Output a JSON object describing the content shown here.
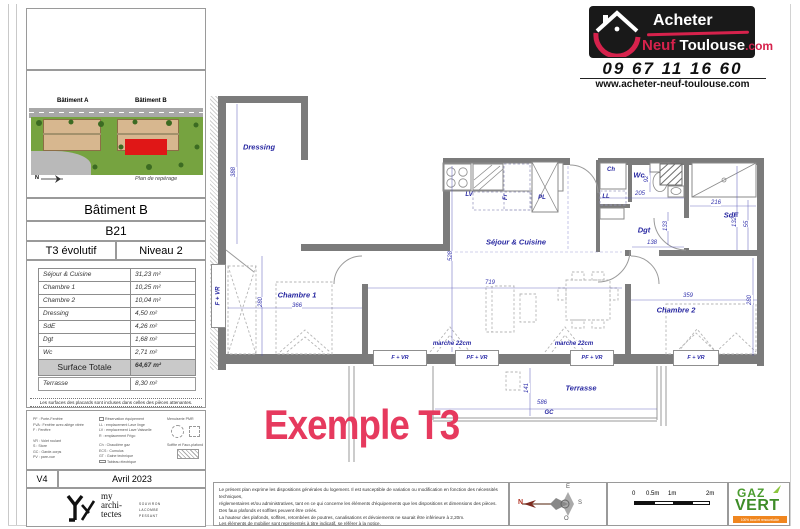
{
  "header": {
    "logo": {
      "acheter": "Acheter",
      "neuf": "Neuf",
      "toulouse": "Toulouse",
      "com": ".com"
    },
    "phone": "09 67 11 16 60",
    "website": "www.acheter-neuf-toulouse.com"
  },
  "sidebar": {
    "siteplan": {
      "building_a": "Bâtiment A",
      "building_b": "Bâtiment B",
      "caption": "Plan de repérage",
      "north": "N"
    },
    "unit": {
      "building": "Bâtiment B",
      "code": "B21",
      "type": "T3 évolutif",
      "level": "Niveau 2"
    },
    "areas": {
      "rows": [
        {
          "label": "Séjour & Cuisine",
          "value": "31,23 m²"
        },
        {
          "label": "Chambre 1",
          "value": "10,25 m²"
        },
        {
          "label": "Chambre 2",
          "value": "10,04 m²"
        },
        {
          "label": "Dressing",
          "value": "4,50 m²"
        },
        {
          "label": "SdE",
          "value": "4,26 m²"
        },
        {
          "label": "Dgt",
          "value": "1,68 m²"
        },
        {
          "label": "Wc",
          "value": "2,71 m²"
        }
      ],
      "total": {
        "label": "Surface Totale",
        "value": "64,67 m²"
      },
      "terrace": {
        "label": "Terrasse",
        "value": "8,30 m²"
      },
      "note": "Les surfaces des placards sont incluses dans celles des pièces attenantes."
    },
    "legend": {
      "col1": [
        "PF : Porte-Fenêtre",
        "FVA : Fenêtre avec allège vitrée",
        "F : Fenêtre",
        "VR : Volet roulant",
        "S : Store",
        "GC : Garde-corps",
        "PV : pare-vue"
      ],
      "col2": [
        "Réservation équipement",
        "LL : emplacement Lave linge",
        "LV : emplacement Lave Vaisselle",
        "R : emplacement Frigo",
        "Ch : Chaudière gaz",
        "ECS : Cumulus",
        "GT : Gaine technique",
        "Tableau électrique"
      ],
      "pmr": "Menuiserie PMR",
      "soffite": "Soffite et Faux-plafond"
    },
    "version": "V4",
    "date": "Avril 2023",
    "architect": {
      "l1": "my",
      "l2": "archi-",
      "l3": "tectes",
      "p1": "SOUVIRON",
      "p2": "LACOMBE",
      "p3": "PESSANT"
    }
  },
  "plan": {
    "rooms": {
      "dressing": "Dressing",
      "sejour": "Séjour & Cuisine",
      "chambre1": "Chambre 1",
      "chambre2": "Chambre 2",
      "sde": "SdE",
      "dgt": "Dgt",
      "wc": "Wc",
      "terrasse": "Terrasse"
    },
    "labels": {
      "lv": "LV",
      "fr": "Fr",
      "pl": "PL",
      "ch": "Ch",
      "ll": "LL",
      "gc": "GC",
      "marche": "marche 22cm"
    },
    "windows": {
      "f_vr": "F + VR",
      "pf_vr": "PF + VR"
    },
    "dims": {
      "d388": "388",
      "d280a": "280",
      "d366": "366",
      "d719": "719",
      "d528": "528",
      "d359": "359",
      "d280b": "280",
      "d205": "205",
      "d92": "92",
      "d216": "216",
      "d132": "132",
      "d55": "55",
      "d138": "138",
      "d133": "133",
      "d141": "141",
      "d586": "586"
    },
    "example": "Exemple T3"
  },
  "footer": {
    "disclaimer": [
      "Le présent plan exprime les dispositions générales du logement. Il est susceptible de variation ou modification en fonction des nécessités techniques,",
      "réglementaires et/ou administratives, tant en ce qui concerne les éléments d'équipements que les dispositions et dimensions des pièces.",
      "Des faux plafonds et soffites peuvent être créés.",
      "La hauteur des plafonds, soffites, retombées de poutres, canalisations et dévoiements ne saurait être inférieure à 2,20m.",
      "Les éléments de mobilier sont représentés à titre indicatif, se référer à la notice."
    ],
    "compass": {
      "n": "N",
      "e": "E",
      "s": "S",
      "o": "O"
    },
    "scale": {
      "t0": "0",
      "t05": "0.5m",
      "t1": "1m",
      "t2": "2m"
    },
    "gazvert": {
      "gaz": "GAZ",
      "vert": "VERT",
      "tagline": "100% local et renouvelable"
    }
  }
}
